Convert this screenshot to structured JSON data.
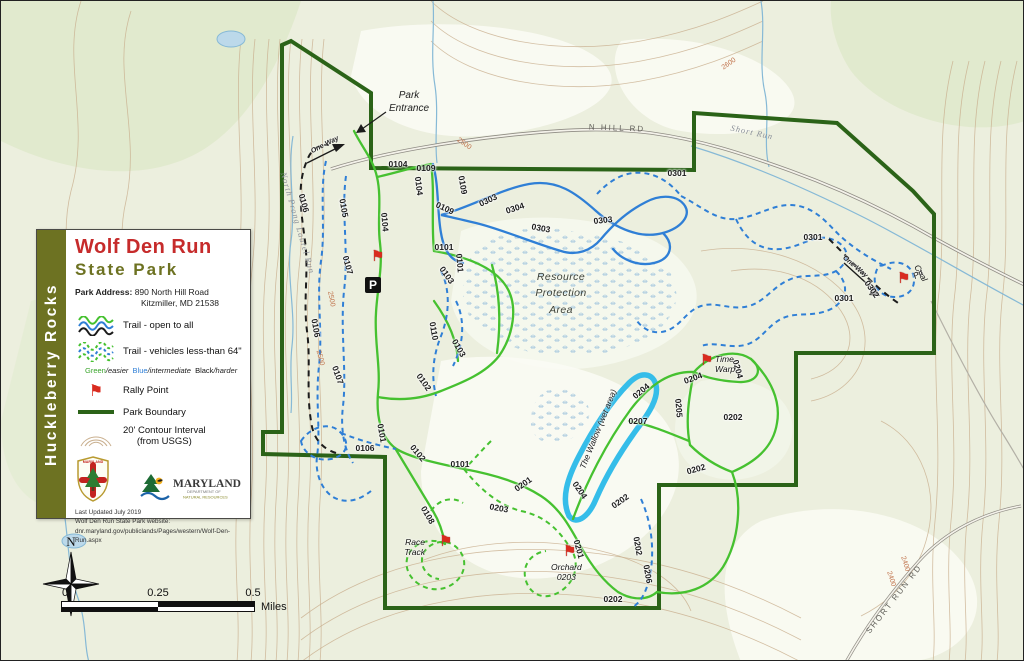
{
  "colors": {
    "boundary": "#2b6318",
    "trail_green": "#46c130",
    "trail_blue": "#2f7fd6",
    "trail_black": "#1c1c1c",
    "wallow": "#35bde9",
    "rally_red": "#d92b1f",
    "legend_olive": "#6d7222",
    "title_red": "#c62b2b"
  },
  "legend": {
    "sidebar_title": "Huckleberry Rocks",
    "park_name_line1": "Wolf Den Run",
    "park_name_line2": "State Park",
    "address_label": "Park Address:",
    "address_line1": "890 North Hill Road",
    "address_line2": "Kitzmiller, MD 21538",
    "trail_open_label": "Trail - open to all",
    "trail_vehicle_label": "Trail - vehicles less-than 64\"",
    "difficulty": {
      "green": "Green",
      "easier": "/easier",
      "blue": "Blue",
      "intermediate": "/intermediate",
      "black": "Black",
      "harder": "/harder"
    },
    "rally_label": "Rally Point",
    "boundary_label": "Park Boundary",
    "contour_line1": "20' Contour Interval",
    "contour_line2": "(from USGS)",
    "logos": {
      "shield_text": "MARYLAND",
      "dnr_name": "MARYLAND",
      "dnr_sub1": "DEPARTMENT OF",
      "dnr_sub2": "NATURAL RESOURCES"
    },
    "updated": "Last Updated July 2019",
    "website_intro": "Wolf Den Run State Park website:",
    "website_url": "dnr.maryland.gov/publiclands/Pages/western/Wolf-Den-Run.aspx"
  },
  "map": {
    "entrance_label": "Park\nEntrance",
    "rpa_label": "Resource\nProtection\nArea",
    "parking_label": "P",
    "rally_points": [
      {
        "label": ""
      },
      {
        "label": "Pit"
      },
      {
        "label": "Time\nWarp"
      },
      {
        "label": "Race\nTrack"
      },
      {
        "label": "Orchard\n0203"
      }
    ],
    "labels": [
      {
        "t": "0104",
        "x": 397,
        "y": 163,
        "r": 0,
        "c": "tl"
      },
      {
        "t": "0109",
        "x": 425,
        "y": 167,
        "r": 0,
        "c": "tl"
      },
      {
        "t": "0104",
        "x": 418,
        "y": 185,
        "r": 83,
        "c": "tl"
      },
      {
        "t": "0104",
        "x": 384,
        "y": 221,
        "r": 85,
        "c": "tl"
      },
      {
        "t": "0109",
        "x": 462,
        "y": 184,
        "r": 80,
        "c": "tl"
      },
      {
        "t": "0109",
        "x": 444,
        "y": 207,
        "r": 25,
        "c": "tl"
      },
      {
        "t": "0303",
        "x": 487,
        "y": 199,
        "r": -25,
        "c": "tl"
      },
      {
        "t": "0304",
        "x": 514,
        "y": 207,
        "r": -18,
        "c": "tl"
      },
      {
        "t": "0303",
        "x": 540,
        "y": 227,
        "r": 10,
        "c": "tl"
      },
      {
        "t": "0303",
        "x": 602,
        "y": 219,
        "r": -6,
        "c": "tl"
      },
      {
        "t": "0301",
        "x": 676,
        "y": 172,
        "r": 0,
        "c": "tl"
      },
      {
        "t": "0301",
        "x": 812,
        "y": 236,
        "r": 0,
        "c": "tl"
      },
      {
        "t": "0301",
        "x": 843,
        "y": 297,
        "r": 0,
        "c": "tl"
      },
      {
        "t": "0302",
        "x": 871,
        "y": 288,
        "r": 55,
        "c": "tl"
      },
      {
        "t": "0101",
        "x": 443,
        "y": 246,
        "r": 0,
        "c": "tl"
      },
      {
        "t": "0101",
        "x": 459,
        "y": 262,
        "r": 85,
        "c": "tl"
      },
      {
        "t": "0110",
        "x": 433,
        "y": 330,
        "r": 80,
        "c": "tl"
      },
      {
        "t": "0103",
        "x": 446,
        "y": 274,
        "r": 55,
        "c": "tl"
      },
      {
        "t": "0103",
        "x": 458,
        "y": 347,
        "r": 60,
        "c": "tl"
      },
      {
        "t": "0102",
        "x": 423,
        "y": 381,
        "r": 55,
        "c": "tl"
      },
      {
        "t": "0102",
        "x": 417,
        "y": 452,
        "r": 50,
        "c": "tl"
      },
      {
        "t": "0101",
        "x": 381,
        "y": 432,
        "r": 80,
        "c": "tl"
      },
      {
        "t": "0101",
        "x": 459,
        "y": 463,
        "r": 0,
        "c": "tl"
      },
      {
        "t": "0105",
        "x": 343,
        "y": 207,
        "r": 80,
        "c": "tl"
      },
      {
        "t": "0107",
        "x": 347,
        "y": 264,
        "r": 75,
        "c": "tl"
      },
      {
        "t": "0107",
        "x": 337,
        "y": 374,
        "r": 70,
        "c": "tl"
      },
      {
        "t": "0106",
        "x": 303,
        "y": 202,
        "r": 75,
        "c": "tl"
      },
      {
        "t": "0106",
        "x": 315,
        "y": 327,
        "r": 80,
        "c": "tl"
      },
      {
        "t": "0106",
        "x": 364,
        "y": 447,
        "r": 0,
        "c": "tl"
      },
      {
        "t": "0108",
        "x": 427,
        "y": 514,
        "r": 60,
        "c": "tl"
      },
      {
        "t": "0201",
        "x": 522,
        "y": 483,
        "r": -35,
        "c": "tl"
      },
      {
        "t": "0203",
        "x": 498,
        "y": 507,
        "r": 10,
        "c": "tl"
      },
      {
        "t": "0201",
        "x": 578,
        "y": 548,
        "r": 75,
        "c": "tl"
      },
      {
        "t": "0204",
        "x": 579,
        "y": 489,
        "r": 55,
        "c": "tl"
      },
      {
        "t": "0204",
        "x": 640,
        "y": 390,
        "r": -40,
        "c": "tl"
      },
      {
        "t": "0204",
        "x": 692,
        "y": 377,
        "r": -20,
        "c": "tl"
      },
      {
        "t": "0204",
        "x": 737,
        "y": 368,
        "r": 75,
        "c": "tl"
      },
      {
        "t": "0205",
        "x": 678,
        "y": 407,
        "r": 85,
        "c": "tl"
      },
      {
        "t": "0207",
        "x": 637,
        "y": 420,
        "r": 0,
        "c": "tl"
      },
      {
        "t": "0202",
        "x": 732,
        "y": 416,
        "r": 0,
        "c": "tl"
      },
      {
        "t": "0202",
        "x": 695,
        "y": 468,
        "r": -15,
        "c": "tl"
      },
      {
        "t": "0202",
        "x": 619,
        "y": 500,
        "r": -35,
        "c": "tl"
      },
      {
        "t": "0202",
        "x": 637,
        "y": 545,
        "r": 80,
        "c": "tl"
      },
      {
        "t": "0206",
        "x": 647,
        "y": 573,
        "r": 80,
        "c": "tl"
      },
      {
        "t": "0202",
        "x": 612,
        "y": 598,
        "r": 0,
        "c": "tl"
      },
      {
        "t": "Coal",
        "x": 920,
        "y": 272,
        "r": 60,
        "c": "rp"
      },
      {
        "t": "The Wallow (wet area)",
        "x": 597,
        "y": 428,
        "r": -68,
        "c": "wl"
      },
      {
        "t": "One-Way",
        "x": 324,
        "y": 144,
        "r": -27,
        "c": "ow"
      },
      {
        "t": "One-Way",
        "x": 854,
        "y": 266,
        "r": 40,
        "c": "ow"
      },
      {
        "t": "N HILL RD",
        "x": 616,
        "y": 127,
        "r": 2,
        "c": "rd"
      },
      {
        "t": "SHORT RUN RD",
        "x": 893,
        "y": 598,
        "r": -52,
        "c": "rd"
      },
      {
        "t": "North Prong Laurel Run",
        "x": 297,
        "y": 222,
        "r": 74,
        "c": "st"
      },
      {
        "t": "Short Run",
        "x": 751,
        "y": 131,
        "r": 12,
        "c": "st"
      },
      {
        "t": "2500",
        "x": 330,
        "y": 298,
        "r": 80,
        "c": "cl"
      },
      {
        "t": "2500",
        "x": 319,
        "y": 357,
        "r": 75,
        "c": "cl"
      },
      {
        "t": "2600",
        "x": 728,
        "y": 63,
        "r": -35,
        "c": "cl"
      },
      {
        "t": "2500",
        "x": 463,
        "y": 143,
        "r": 35,
        "c": "cl"
      },
      {
        "t": "2400",
        "x": 890,
        "y": 578,
        "r": 72,
        "c": "cl"
      },
      {
        "t": "2400",
        "x": 904,
        "y": 563,
        "r": 72,
        "c": "cl"
      }
    ]
  },
  "scalebar": {
    "tick0": "0",
    "tick1": "0.25",
    "tick2": "0.5",
    "unit": "Miles"
  },
  "compass": {
    "label": "N"
  }
}
